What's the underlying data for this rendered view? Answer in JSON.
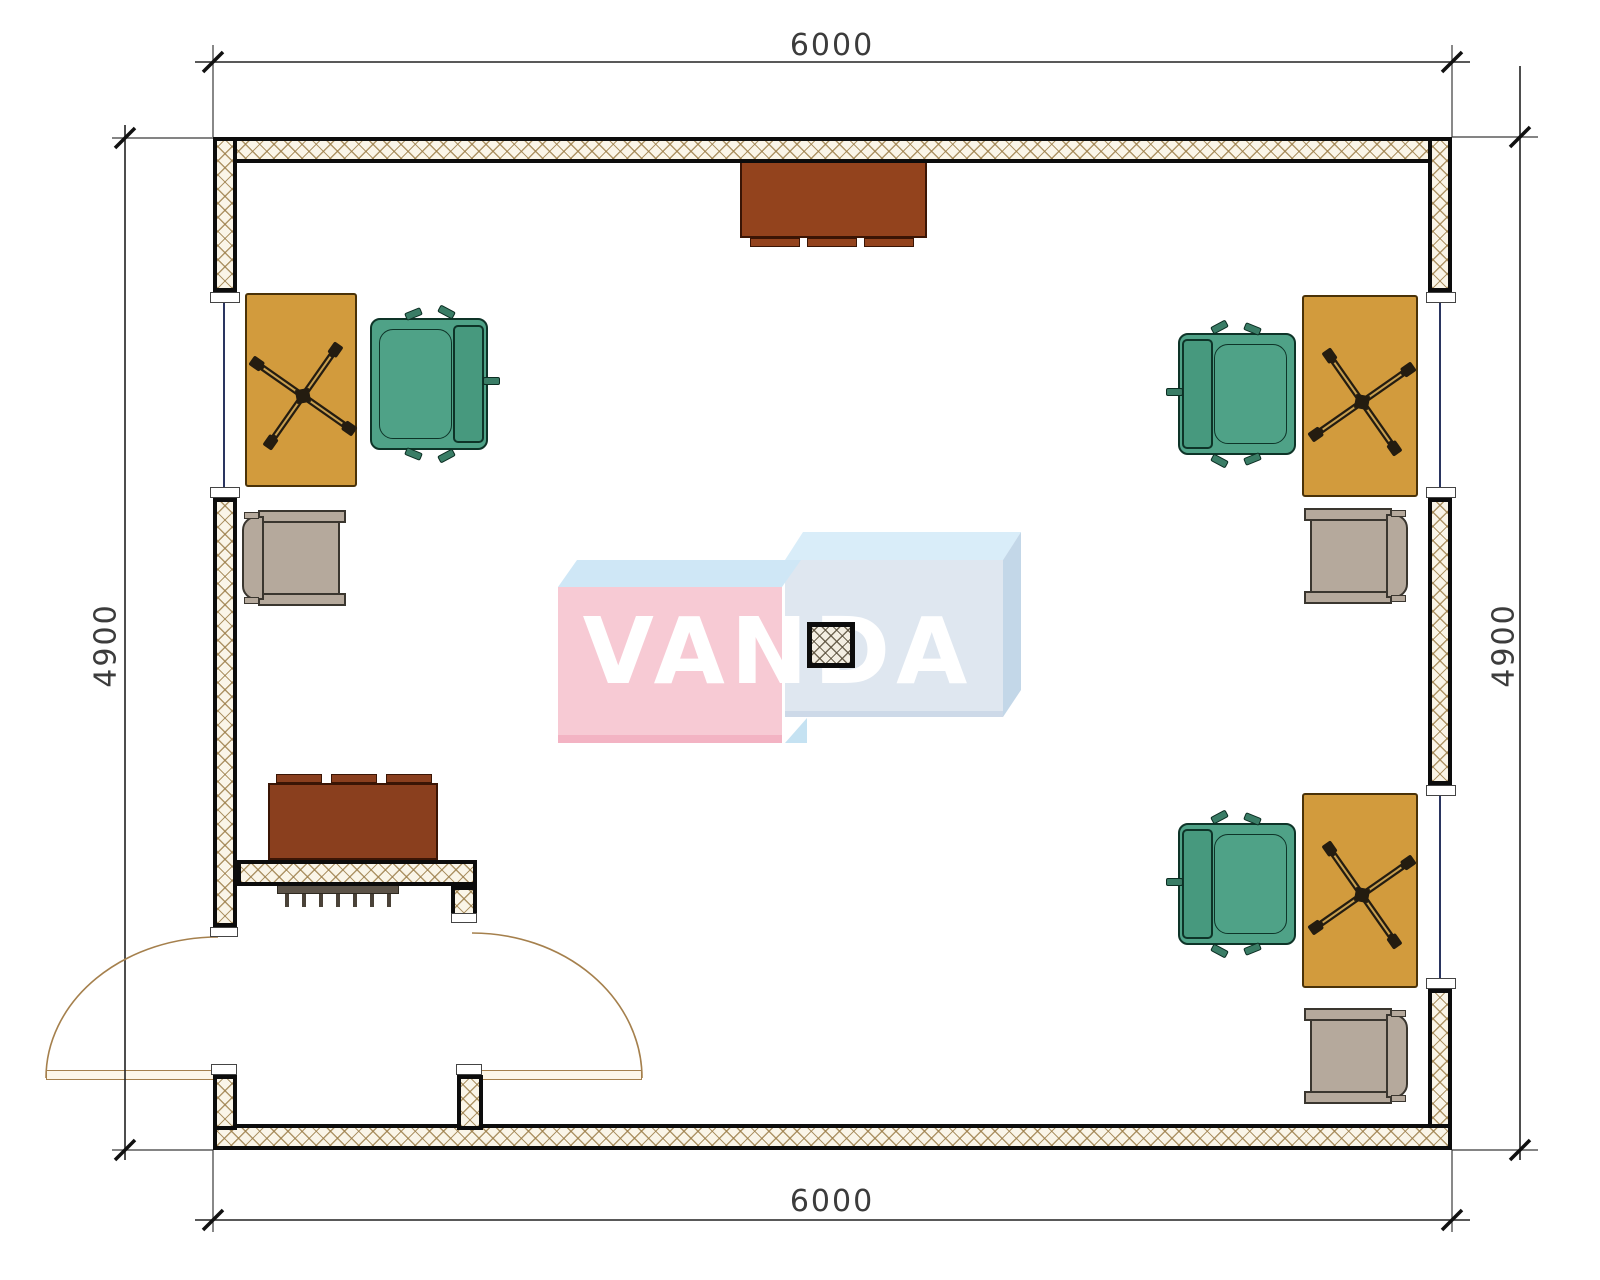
{
  "title": "office-floor-plan",
  "watermark": {
    "text": "VANDA",
    "left_box_front": "#f7cad4",
    "left_box_strip": "#f3b3c3",
    "left_box_top": "#cfe7f6",
    "right_box_front": "#dfe7f0",
    "right_box_top": "#d9edf9",
    "right_box_side": "#c3d7e8",
    "right_box_strip": "#cdd9e8",
    "right_box_flap": "#c5e2f2",
    "text_color": "#ffffff"
  },
  "dimensions": {
    "top": {
      "label": "6000"
    },
    "bottom": {
      "label": "6000"
    },
    "left": {
      "label": "4900"
    },
    "right": {
      "label": "4900"
    }
  },
  "colors": {
    "desk": "#d29b3d",
    "desk_border": "#4a3208",
    "chair_green": "#4fa287",
    "chair_green_back": "#47997e",
    "chair_green_leg": "#3a7d66",
    "chair_gray": "#b5a99c",
    "cabinet_top": "#93431d",
    "cabinet_low": "#8a3f1e",
    "radiator": "#5c5348",
    "radiator_tick": "#4a4238",
    "glass_line": "#2a3560",
    "door_line": "#a5804d",
    "dim_line": "#222222",
    "cross": "#241c10",
    "cross_inner": "#c9a050"
  },
  "plan": {
    "walls": [
      {
        "name": "wall-top",
        "x": 213,
        "y": 137,
        "w": 1239,
        "h": 26
      },
      {
        "name": "wall-left-upper",
        "x": 213,
        "y": 137,
        "w": 24,
        "h": 155
      },
      {
        "name": "wall-left-mid",
        "x": 213,
        "y": 498,
        "w": 24,
        "h": 429
      },
      {
        "name": "wall-right-upper",
        "x": 1428,
        "y": 137,
        "w": 24,
        "h": 155
      },
      {
        "name": "wall-right-mid",
        "x": 1428,
        "y": 498,
        "w": 24,
        "h": 287
      },
      {
        "name": "wall-right-lower",
        "x": 1428,
        "y": 989,
        "w": 24,
        "h": 161
      },
      {
        "name": "wall-bottom",
        "x": 213,
        "y": 1124,
        "w": 1239,
        "h": 26
      },
      {
        "name": "wall-door-stub-left",
        "x": 213,
        "y": 1075,
        "w": 24,
        "h": 55
      },
      {
        "name": "wall-door-stub-right",
        "x": 457,
        "y": 1075,
        "w": 26,
        "h": 55
      },
      {
        "name": "wall-partition",
        "x": 237,
        "y": 860,
        "w": 240,
        "h": 26
      },
      {
        "name": "wall-partition-stub",
        "x": 451,
        "y": 886,
        "w": 26,
        "h": 37
      }
    ],
    "caps": [
      {
        "x": 210,
        "y": 292,
        "w": 30,
        "h": 11
      },
      {
        "x": 210,
        "y": 487,
        "w": 30,
        "h": 11
      },
      {
        "x": 1426,
        "y": 292,
        "w": 30,
        "h": 11
      },
      {
        "x": 1426,
        "y": 487,
        "w": 30,
        "h": 11
      },
      {
        "x": 1426,
        "y": 785,
        "w": 30,
        "h": 11
      },
      {
        "x": 1426,
        "y": 978,
        "w": 30,
        "h": 11
      },
      {
        "x": 210,
        "y": 927,
        "w": 28,
        "h": 10
      },
      {
        "x": 451,
        "y": 913,
        "w": 26,
        "h": 10
      },
      {
        "x": 211,
        "y": 1064,
        "w": 26,
        "h": 11
      },
      {
        "x": 456,
        "y": 1064,
        "w": 26,
        "h": 11
      }
    ],
    "windows": [
      {
        "x1": 224,
        "y1": 303,
        "x2": 224,
        "y2": 487
      },
      {
        "x1": 1440,
        "y1": 303,
        "x2": 1440,
        "y2": 487
      },
      {
        "x1": 1440,
        "y1": 796,
        "x2": 1440,
        "y2": 978
      }
    ],
    "door": {
      "leaves": [
        {
          "x": 46,
          "y": 1070,
          "w": 184,
          "h": 10
        },
        {
          "x": 460,
          "y": 1070,
          "w": 182,
          "h": 10
        }
      ],
      "arcs": [
        "M 218 937 A 172 141 0 0 0 46 1078",
        "M 472 933 A 170 145 0 0 1 642 1078"
      ]
    },
    "desks": [
      {
        "x": 245,
        "y": 293,
        "w": 112,
        "h": 194,
        "seat": {
          "x": 268,
          "y": 352,
          "w": 72,
          "h": 82
        },
        "cross": {
          "cx": 303,
          "cy": 396,
          "rot": 35
        }
      },
      {
        "x": 1302,
        "y": 295,
        "w": 116,
        "h": 202,
        "seat": {
          "x": 1327,
          "y": 362,
          "w": 72,
          "h": 82
        },
        "cross": {
          "cx": 1362,
          "cy": 402,
          "rot": -35
        }
      },
      {
        "x": 1302,
        "y": 793,
        "w": 116,
        "h": 195,
        "seat": {
          "x": 1327,
          "y": 855,
          "w": 72,
          "h": 82
        },
        "cross": {
          "cx": 1362,
          "cy": 895,
          "rot": -35
        }
      }
    ],
    "chairs_green": [
      {
        "x": 370,
        "y": 318,
        "w": 118,
        "h": 132,
        "back": "right"
      },
      {
        "x": 1178,
        "y": 333,
        "w": 118,
        "h": 122,
        "back": "left"
      },
      {
        "x": 1178,
        "y": 823,
        "w": 118,
        "h": 122,
        "back": "left"
      }
    ],
    "chairs_gray": [
      {
        "x": 238,
        "y": 502,
        "w": 112,
        "h": 112,
        "back": "left"
      },
      {
        "x": 1300,
        "y": 500,
        "w": 112,
        "h": 112,
        "back": "right"
      },
      {
        "x": 1300,
        "y": 1000,
        "w": 112,
        "h": 112,
        "back": "right"
      }
    ],
    "cabinets": [
      {
        "name": "cabinet-top-wall",
        "x": 740,
        "y": 160,
        "w": 187,
        "h": 78,
        "tabs": "bottom",
        "tab_x": [
          750,
          807,
          864
        ],
        "tab_w": 50,
        "color_key": "cabinet_top"
      },
      {
        "name": "cabinet-vestibule",
        "x": 268,
        "y": 783,
        "w": 170,
        "h": 77,
        "tabs": "top",
        "tab_x": [
          276,
          331,
          386
        ],
        "tab_w": 46,
        "color_key": "cabinet_low"
      }
    ],
    "radiator": {
      "x": 277,
      "y": 883,
      "w": 122,
      "h": 11,
      "ticks": 7
    },
    "column": {
      "x": 807,
      "y": 622,
      "w": 48,
      "h": 46
    },
    "dim_geometry": {
      "top": {
        "line": [
          195,
          62,
          1470,
          62
        ],
        "ticks": [
          [
            213,
            62
          ],
          [
            1452,
            62
          ]
        ],
        "ext": [
          [
            213,
            45,
            213,
            137
          ],
          [
            1452,
            45,
            1452,
            137
          ]
        ]
      },
      "bottom": {
        "line": [
          195,
          1220,
          1470,
          1220
        ],
        "ticks": [
          [
            213,
            1220
          ],
          [
            1452,
            1220
          ]
        ],
        "ext": [
          [
            213,
            1150,
            213,
            1232
          ],
          [
            1452,
            1150,
            1452,
            1232
          ]
        ]
      },
      "left": {
        "line": [
          125,
          125,
          125,
          1160
        ],
        "ticks": [
          [
            125,
            138
          ],
          [
            125,
            1150
          ]
        ],
        "ext": [
          [
            112,
            138,
            213,
            138
          ],
          [
            112,
            1150,
            213,
            1150
          ]
        ]
      },
      "right": {
        "line": [
          1520,
          66,
          1520,
          1160
        ],
        "ticks": [
          [
            1520,
            137
          ],
          [
            1520,
            1150
          ]
        ],
        "ext": [
          [
            1452,
            137,
            1538,
            137
          ],
          [
            1452,
            1150,
            1538,
            1150
          ]
        ]
      }
    },
    "watermark_geometry": {
      "left_top": [
        [
          558,
          587
        ],
        [
          577,
          560
        ],
        [
          801,
          560
        ],
        [
          782,
          587
        ]
      ],
      "left_front": [
        558,
        587,
        224,
        155
      ],
      "left_strip": [
        558,
        735,
        224,
        8
      ],
      "right_top": [
        [
          785,
          560
        ],
        [
          803,
          532
        ],
        [
          1021,
          532
        ],
        [
          1003,
          560
        ]
      ],
      "right_side": [
        [
          1003,
          560
        ],
        [
          1021,
          532
        ],
        [
          1021,
          690
        ],
        [
          1003,
          717
        ]
      ],
      "right_front": [
        785,
        560,
        218,
        157
      ],
      "right_strip": [
        785,
        711,
        218,
        6
      ],
      "right_flap": [
        [
          785,
          743
        ],
        [
          807,
          718
        ],
        [
          807,
          743
        ]
      ]
    }
  }
}
